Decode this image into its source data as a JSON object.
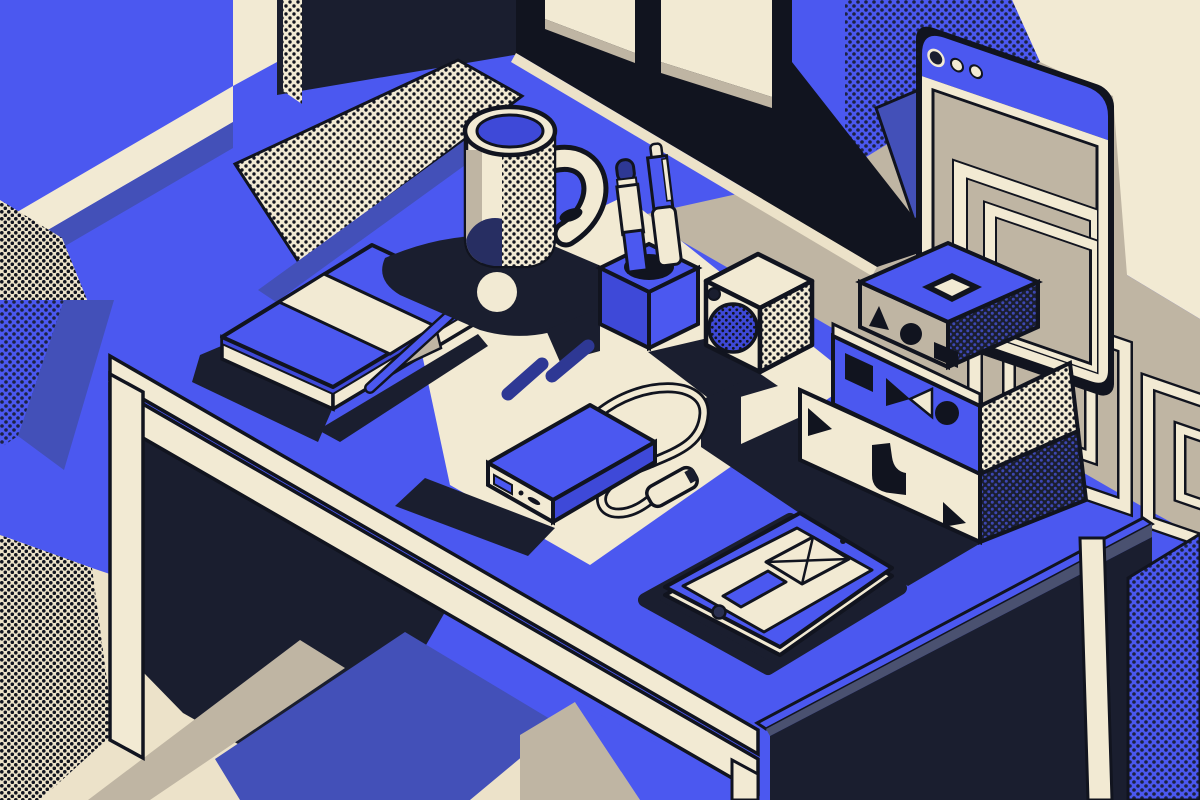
{
  "scene": {
    "description": "Flat isometric illustration of a tidy desk workspace: coffee mug, notebook with elastic band, pen holder with two pens, cube speaker, three stacked geometric boxes, power bank with USB cable, tablet showing an envelope wireframe, in front of a window and an abstract browser window, rendered in blue, cream, taupe and dark navy with halftone dot textures.",
    "style": "flat isometric vector illustration with halftone dots"
  },
  "palette": {
    "ink": "#11141f",
    "navy": "#1a1e2f",
    "blue": "#4b58f0",
    "blueDeep": "#3e49d8",
    "indigo": "#4350b8",
    "penBlue": "#2e3894",
    "cream": "#f2ead3",
    "cream2": "#ece2c9",
    "taupe": "#bfb5a3",
    "greyBlue": "#4a5170",
    "dotOnBlue": "#1c2242",
    "dotOnNavy": "#3d47b2"
  },
  "objects": [
    {
      "label": "window frame"
    },
    {
      "label": "browser window with three dots"
    },
    {
      "label": "coffee mug"
    },
    {
      "label": "notebook"
    },
    {
      "label": "pen holder with two pens"
    },
    {
      "label": "cube speaker"
    },
    {
      "label": "stacked geometric boxes"
    },
    {
      "label": "power bank with usb cable"
    },
    {
      "label": "tablet with envelope icon"
    },
    {
      "label": "desk"
    },
    {
      "label": "rug diamond"
    }
  ]
}
